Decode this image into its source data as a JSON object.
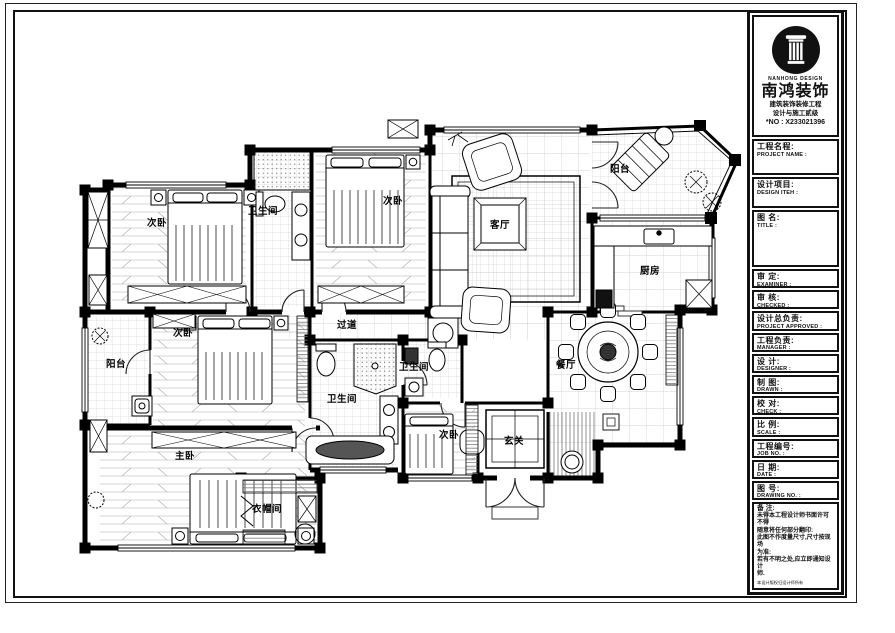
{
  "title_block": {
    "logo": {
      "brand_en": "NANHONG DESIGN",
      "brand_cn": "南鸿装饰",
      "sub1": "建筑装饰装修工程",
      "sub2": "设计与施工贰级",
      "license": "*NO : X233021396"
    },
    "fields": [
      {
        "cn": "工程名程:",
        "en": "PROJECT NAME :"
      },
      {
        "cn": "设计项目:",
        "en": "DESIGN ITEH :"
      },
      {
        "cn": "图 名:",
        "en": "TITLE :"
      },
      {
        "cn": "审  定:",
        "en": "EXAMINER :"
      },
      {
        "cn": "审  核:",
        "en": "CHECKED :"
      },
      {
        "cn": "设计总负责:",
        "en": "PROJECT APPROVED :"
      },
      {
        "cn": "工程负责:",
        "en": "MANAGER :"
      },
      {
        "cn": "设  计:",
        "en": "DESIGNER :"
      },
      {
        "cn": "制  图:",
        "en": "DRAWN :"
      },
      {
        "cn": "校  对:",
        "en": "CHECK :"
      },
      {
        "cn": "比  例:",
        "en": "SCALE :"
      },
      {
        "cn": "工程编号:",
        "en": "JOB NO. :"
      },
      {
        "cn": "日  期:",
        "en": "DATE :"
      },
      {
        "cn": "图  号:",
        "en": "DRAWING NO. :"
      }
    ],
    "notes": {
      "title": "备 注:",
      "lines": [
        "未得本工程设计师书面许可不得",
        "随意将任何部分翻印:",
        "此图不作度量尺寸,尺寸按现场",
        "为准:",
        "若有不明之处,应立即通知设计",
        "师."
      ],
      "fine_print": "本设计版权归设计师所有",
      "phone": "免费咨询电话:400 8383 168"
    }
  },
  "plan": {
    "rooms": [
      {
        "id": "bedroom-top-left",
        "label": "次卧"
      },
      {
        "id": "bathroom-top",
        "label": "卫生间"
      },
      {
        "id": "bedroom-top-middle",
        "label": "次卧"
      },
      {
        "id": "living-room",
        "label": "客厅"
      },
      {
        "id": "balcony-top-right",
        "label": "阳台"
      },
      {
        "id": "kitchen",
        "label": "厨房"
      },
      {
        "id": "bedroom-mid-left",
        "label": "次卧"
      },
      {
        "id": "balcony-left",
        "label": "阳台"
      },
      {
        "id": "corridor",
        "label": "过道"
      },
      {
        "id": "bathroom-small",
        "label": "卫生间"
      },
      {
        "id": "bathroom-master",
        "label": "卫生间"
      },
      {
        "id": "dining-room",
        "label": "餐厅"
      },
      {
        "id": "master-bedroom",
        "label": "主卧"
      },
      {
        "id": "bedroom-bottom",
        "label": "次卧"
      },
      {
        "id": "entry",
        "label": "玄关"
      },
      {
        "id": "cloakroom",
        "label": "衣帽间"
      }
    ]
  }
}
